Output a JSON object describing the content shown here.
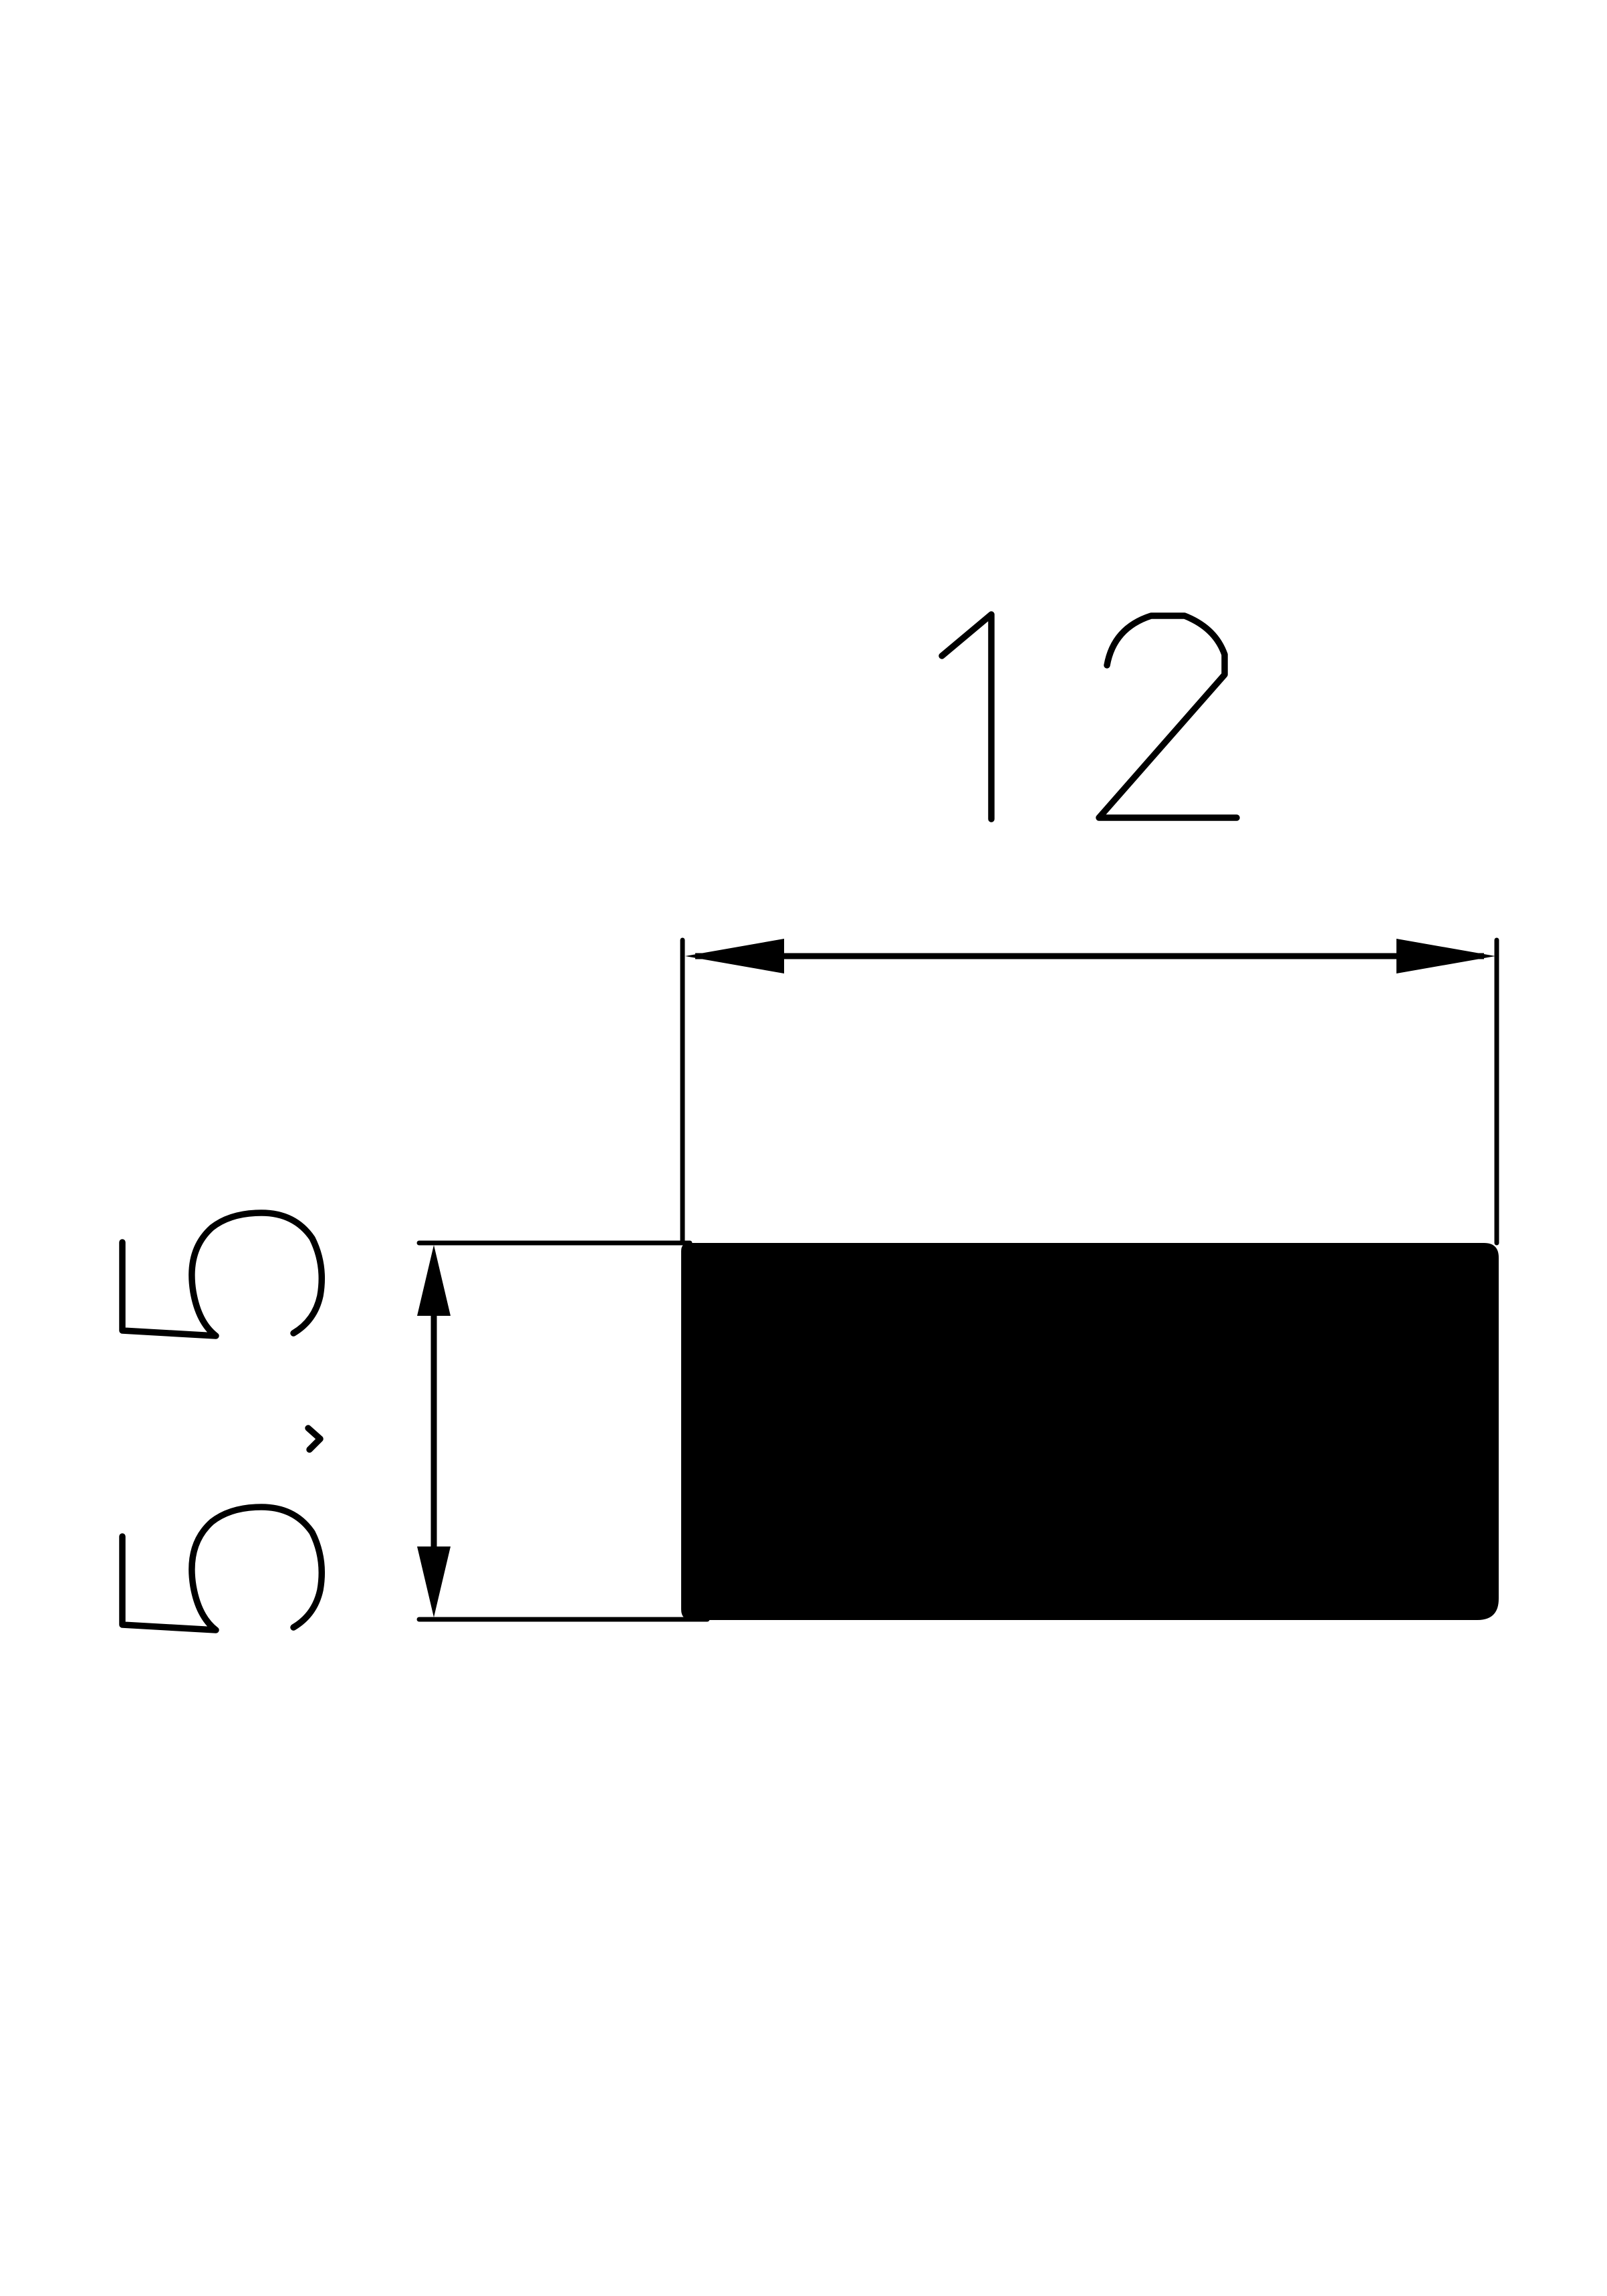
{
  "page": {
    "background_color": "#ffffff",
    "ink_color": "#000000"
  },
  "drawing": {
    "type": "technical-dimension-drawing",
    "profile": {
      "shape": "solid-filled rectangle cross-section",
      "fill_color": "#000000"
    },
    "dimensions": {
      "width": {
        "label": "12",
        "value": 12,
        "orientation": "horizontal",
        "arrow_style": "double-headed-arrow-between-extension-lines"
      },
      "height": {
        "label": "5.5",
        "value": 5.5,
        "orientation": "vertical-rotated-90ccw",
        "arrow_style": "double-headed-arrow-between-extension-lines"
      }
    },
    "icons": {
      "width_arrowhead_left": "filled-triangle-pointing-left",
      "width_arrowhead_right": "filled-triangle-pointing-right",
      "height_arrowhead_top": "filled-triangle-pointing-up",
      "height_arrowhead_bottom": "filled-triangle-pointing-down"
    }
  }
}
